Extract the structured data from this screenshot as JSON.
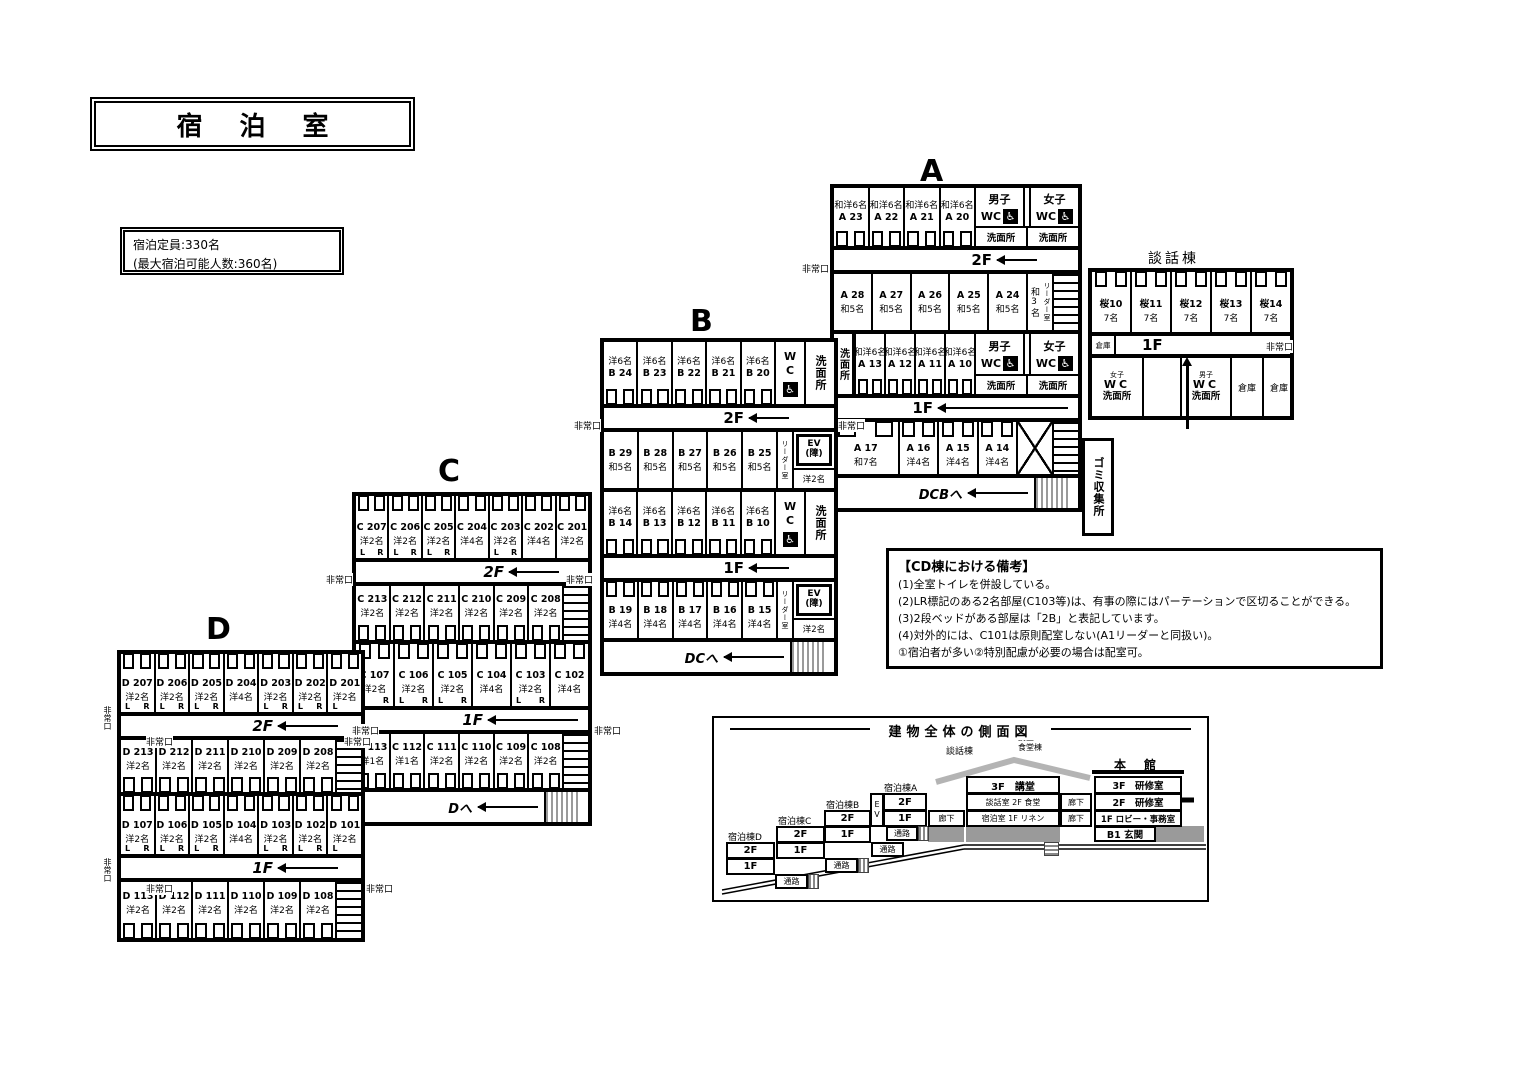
{
  "title": "宿 泊 室",
  "capacity": {
    "line1": "宿泊定員:330名",
    "line2": "(最大宿泊可能人数:360名)"
  },
  "colors": {
    "wall": "#000000",
    "ground_gray": "#9a9a9a",
    "background": "#ffffff"
  },
  "labels": {
    "f2": "2F",
    "f1": "1F",
    "emergency": "非常口",
    "to_dcb": "DCBへ",
    "to_dc": "DCへ",
    "to_d": "Dへ",
    "garbage": "ゴミ収集所",
    "washroom": "洗面所",
    "wc": "WC",
    "male": "男子",
    "female": "女子",
    "leader": "リーダー室",
    "leader_cap": "和3名",
    "ev": "EV",
    "shou": "(障)",
    "cap2": "洋2名",
    "storage": "倉庫",
    "wheelchair": "♿"
  },
  "bldg_a": {
    "name": "A",
    "f2_top": [
      {
        "l1": "和洋6名",
        "l2": "A 23"
      },
      {
        "l1": "和洋6名",
        "l2": "A 22"
      },
      {
        "l1": "和洋6名",
        "l2": "A 21"
      },
      {
        "l1": "和洋6名",
        "l2": "A 20"
      }
    ],
    "f2_mid": [
      {
        "l1": "A 28",
        "l2": "和5名"
      },
      {
        "l1": "A 27",
        "l2": "和5名"
      },
      {
        "l1": "A 26",
        "l2": "和5名"
      },
      {
        "l1": "A 25",
        "l2": "和5名"
      },
      {
        "l1": "A 24",
        "l2": "和5名"
      }
    ],
    "f1_top": [
      {
        "l1": "和洋6名",
        "l2": "A 13"
      },
      {
        "l1": "和洋6名",
        "l2": "A 12"
      },
      {
        "l1": "和洋6名",
        "l2": "A 11"
      },
      {
        "l1": "和洋6名",
        "l2": "A 10"
      }
    ],
    "f1_bot": [
      {
        "l1": "A 17",
        "l2": "和7名",
        "cls": "wide"
      },
      {
        "l1": "A 16",
        "l2": "洋4名"
      },
      {
        "l1": "A 15",
        "l2": "洋4名"
      },
      {
        "l1": "A 14",
        "l2": "洋4名"
      }
    ]
  },
  "bldg_b": {
    "name": "B",
    "f2_top": [
      {
        "l1": "洋6名",
        "l2": "B 24"
      },
      {
        "l1": "洋6名",
        "l2": "B 23"
      },
      {
        "l1": "洋6名",
        "l2": "B 22"
      },
      {
        "l1": "洋6名",
        "l2": "B 21"
      },
      {
        "l1": "洋6名",
        "l2": "B 20"
      }
    ],
    "f2_mid": [
      {
        "l1": "B 29",
        "l2": "和5名"
      },
      {
        "l1": "B 28",
        "l2": "和5名"
      },
      {
        "l1": "B 27",
        "l2": "和5名"
      },
      {
        "l1": "B 26",
        "l2": "和5名"
      },
      {
        "l1": "B 25",
        "l2": "和5名"
      }
    ],
    "f1_top": [
      {
        "l1": "洋6名",
        "l2": "B 14"
      },
      {
        "l1": "洋6名",
        "l2": "B 13"
      },
      {
        "l1": "洋6名",
        "l2": "B 12"
      },
      {
        "l1": "洋6名",
        "l2": "B 11"
      },
      {
        "l1": "洋6名",
        "l2": "B 10"
      }
    ],
    "f1_bot": [
      {
        "l1": "B 19",
        "l2": "洋4名"
      },
      {
        "l1": "B 18",
        "l2": "洋4名"
      },
      {
        "l1": "B 17",
        "l2": "洋4名"
      },
      {
        "l1": "B 16",
        "l2": "洋4名"
      },
      {
        "l1": "B 15",
        "l2": "洋4名"
      }
    ]
  },
  "bldg_c": {
    "name": "C",
    "f2_top": [
      {
        "l1": "C 207",
        "l2": "洋2名",
        "lr": [
          "L",
          "R"
        ]
      },
      {
        "l1": "C 206",
        "l2": "洋2名",
        "lr": [
          "L",
          "R"
        ]
      },
      {
        "l1": "C 205",
        "l2": "洋2名",
        "lr": [
          "L",
          "R"
        ]
      },
      {
        "l1": "C 204",
        "l2": "洋4名"
      },
      {
        "l1": "C 203",
        "l2": "洋2名",
        "lr": [
          "L",
          "R"
        ]
      },
      {
        "l1": "C 202",
        "l2": "洋4名"
      },
      {
        "l1": "C 201",
        "l2": "洋2名"
      }
    ],
    "f2_bot": [
      {
        "l1": "C 213",
        "l2": "洋2名"
      },
      {
        "l1": "C 212",
        "l2": "洋2名"
      },
      {
        "l1": "C 211",
        "l2": "洋2名"
      },
      {
        "l1": "C 210",
        "l2": "洋2名"
      },
      {
        "l1": "C 209",
        "l2": "洋2名"
      },
      {
        "l1": "C 208",
        "l2": "洋2名"
      }
    ],
    "f1_top": [
      {
        "l1": "C 107",
        "l2": "洋2名",
        "lr": [
          "L",
          "R"
        ]
      },
      {
        "l1": "C 106",
        "l2": "洋2名",
        "lr": [
          "L",
          "R"
        ]
      },
      {
        "l1": "C 105",
        "l2": "洋2名",
        "lr": [
          "L",
          "R"
        ]
      },
      {
        "l1": "C 104",
        "l2": "洋4名"
      },
      {
        "l1": "C 103",
        "l2": "洋2名",
        "lr": [
          "L",
          "R"
        ]
      },
      {
        "l1": "C 102",
        "l2": "洋4名"
      }
    ],
    "f1_bot": [
      {
        "l1": "C 113",
        "l2": "洋1名"
      },
      {
        "l1": "C 112",
        "l2": "洋1名"
      },
      {
        "l1": "C 111",
        "l2": "洋2名"
      },
      {
        "l1": "C 110",
        "l2": "洋2名"
      },
      {
        "l1": "C 109",
        "l2": "洋2名"
      },
      {
        "l1": "C 108",
        "l2": "洋2名"
      }
    ]
  },
  "bldg_d": {
    "name": "D",
    "f2_top": [
      {
        "l1": "D 207",
        "l2": "洋2名",
        "lr": [
          "L",
          "R"
        ]
      },
      {
        "l1": "D 206",
        "l2": "洋2名",
        "lr": [
          "L",
          "R"
        ]
      },
      {
        "l1": "D 205",
        "l2": "洋2名",
        "lr": [
          "L",
          "R"
        ]
      },
      {
        "l1": "D 204",
        "l2": "洋4名"
      },
      {
        "l1": "D 203",
        "l2": "洋2名",
        "lr": [
          "L",
          "R"
        ]
      },
      {
        "l1": "D 202",
        "l2": "洋2名",
        "lr": [
          "L",
          "R"
        ]
      },
      {
        "l1": "D 201",
        "l2": "洋2名",
        "lr": [
          "L",
          ""
        ]
      }
    ],
    "f2_bot": [
      {
        "l1": "D 213",
        "l2": "洋2名"
      },
      {
        "l1": "D 212",
        "l2": "洋2名"
      },
      {
        "l1": "D 211",
        "l2": "洋2名"
      },
      {
        "l1": "D 210",
        "l2": "洋2名"
      },
      {
        "l1": "D 209",
        "l2": "洋2名"
      },
      {
        "l1": "D 208",
        "l2": "洋2名"
      }
    ],
    "f1_top": [
      {
        "l1": "D 107",
        "l2": "洋2名",
        "lr": [
          "L",
          "R"
        ]
      },
      {
        "l1": "D 106",
        "l2": "洋2名",
        "lr": [
          "L",
          "R"
        ]
      },
      {
        "l1": "D 105",
        "l2": "洋2名",
        "lr": [
          "L",
          "R"
        ]
      },
      {
        "l1": "D 104",
        "l2": "洋4名"
      },
      {
        "l1": "D 103",
        "l2": "洋2名",
        "lr": [
          "L",
          "R"
        ]
      },
      {
        "l1": "D 102",
        "l2": "洋2名",
        "lr": [
          "L",
          "R"
        ]
      },
      {
        "l1": "D 101",
        "l2": "洋2名",
        "lr": [
          "L",
          ""
        ]
      }
    ],
    "f1_bot": [
      {
        "l1": "D 113",
        "l2": "洋2名"
      },
      {
        "l1": "D 112",
        "l2": "洋2名"
      },
      {
        "l1": "D 111",
        "l2": "洋2名"
      },
      {
        "l1": "D 110",
        "l2": "洋2名"
      },
      {
        "l1": "D 109",
        "l2": "洋2名"
      },
      {
        "l1": "D 108",
        "l2": "洋2名"
      }
    ]
  },
  "lounge": {
    "title": "談話棟",
    "rooms": [
      {
        "l1": "桜10",
        "l2": "7名"
      },
      {
        "l1": "桜11",
        "l2": "7名"
      },
      {
        "l1": "桜12",
        "l2": "7名"
      },
      {
        "l1": "桜13",
        "l2": "7名"
      },
      {
        "l1": "桜14",
        "l2": "7名"
      }
    ]
  },
  "exits": [
    {
      "t": "非常口",
      "style": "left:802px;top:262px;"
    },
    {
      "t": "非常口",
      "style": "left:574px;top:419px;"
    },
    {
      "t": "非常口",
      "style": "left:838px;top:419px;"
    },
    {
      "t": "非常口",
      "style": "left:326px;top:573px;"
    },
    {
      "t": "非常口",
      "style": "left:566px;top:573px;"
    },
    {
      "t": "非常口",
      "style": "left:352px;top:724px;"
    },
    {
      "t": "非常口",
      "style": "left:594px;top:724px;"
    },
    {
      "t": "非常口",
      "style": "left:146px;top:735px;"
    },
    {
      "t": "非常口",
      "style": "left:344px;top:735px;"
    },
    {
      "t": "非常口",
      "style": "left:146px;top:882px;"
    },
    {
      "t": "非常口",
      "style": "left:366px;top:882px;"
    },
    {
      "t": "非常口",
      "cls": "v",
      "style": "left:102px;top:706px;"
    },
    {
      "t": "非常口",
      "cls": "v",
      "style": "left:102px;top:858px;"
    },
    {
      "t": "非常口",
      "style": "left:1266px;top:340px;"
    }
  ],
  "notes": {
    "title": "【CD棟における備考】",
    "lines": [
      "(1)全室トイレを併設している。",
      "(2)LR標記のある2名部屋(C103等)は、有事の際にはパーテーションで区切ることができる。",
      "(3)2段ベッドがある部屋は「2B」と表記しています。",
      "(4)対外的には、C101は原則配室しない(A1リーダーと同扱い)。",
      "①宿泊者が多い②特別配慮が必要の場合は配室可。"
    ]
  },
  "sideview": {
    "title": "建物全体の側面図",
    "lounge_label": "談話棟",
    "hall_label1": "講堂・",
    "hall_label2": "食堂棟",
    "passage": "通路",
    "corridor": "廊下",
    "ev": "EV",
    "stacks": [
      {
        "label": "宿泊棟D"
      },
      {
        "label": "宿泊棟C"
      },
      {
        "label": "宿泊棟B"
      },
      {
        "label": "宿泊棟A"
      }
    ],
    "mid": {
      "f3": "3F　講堂",
      "f2": "談話室 2F 食堂",
      "f1": "宿泊室 1F リネン"
    },
    "main": {
      "title": "本　館",
      "f3": "3F　研修室",
      "f2": "2F　研修室",
      "f1": "1F ロビー・事務室",
      "b1": "B1 玄関"
    }
  }
}
